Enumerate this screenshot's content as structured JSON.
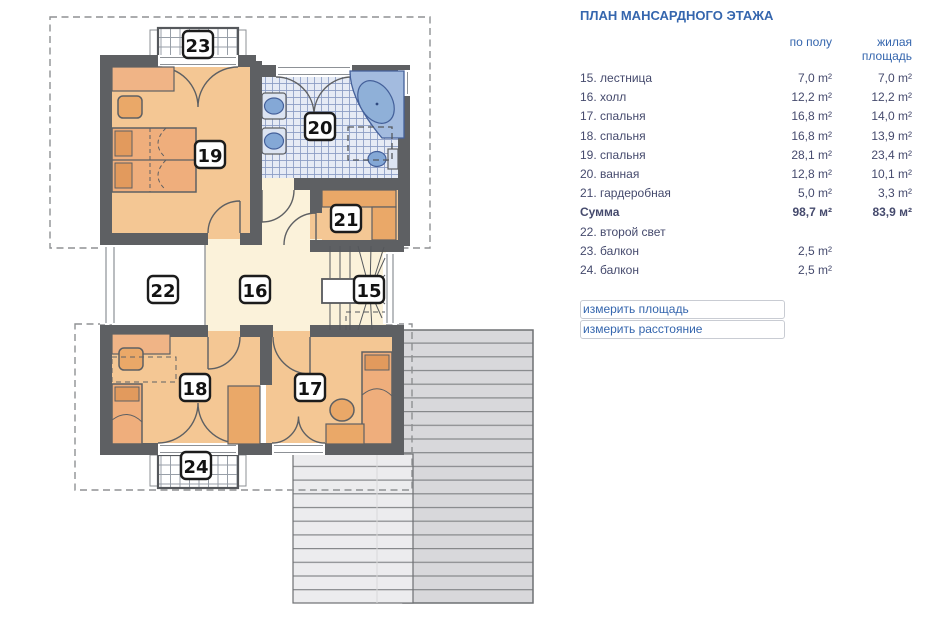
{
  "plan": {
    "labels": {
      "r15": "15",
      "r16": "16",
      "r17": "17",
      "r18": "18",
      "r19": "19",
      "r20": "20",
      "r21": "21",
      "r22": "22",
      "r23": "23",
      "r24": "24"
    }
  },
  "table": {
    "title": "ПЛАН МАНСАРДНОГО ЭТАЖА",
    "col_floor_header": "по полу",
    "col_living_header_line1": "жилая",
    "col_living_header_line2": "площадь",
    "rows": [
      {
        "name": "15. лестница",
        "floor": "7,0 m²",
        "living": "7,0 m²"
      },
      {
        "name": "16. холл",
        "floor": "12,2 m²",
        "living": "12,2 m²"
      },
      {
        "name": "17. спальня",
        "floor": "16,8 m²",
        "living": "14,0 m²"
      },
      {
        "name": "18. спальня",
        "floor": "16,8 m²",
        "living": "13,9 m²"
      },
      {
        "name": "19. спальня",
        "floor": "28,1 m²",
        "living": "23,4 m²"
      },
      {
        "name": "20. ванная",
        "floor": "12,8 m²",
        "living": "10,1 m²"
      },
      {
        "name": "21. гардеробная",
        "floor": "5,0 m²",
        "living": "3,3 m²"
      }
    ],
    "sum_row": {
      "name": "Сумма",
      "floor": "98,7 м²",
      "living": "83,9 м²"
    },
    "extra_rows": [
      {
        "name": "22. второй свет",
        "floor": "",
        "living": ""
      },
      {
        "name": "23. балкон",
        "floor": "2,5 m²",
        "living": ""
      },
      {
        "name": "24. балкон",
        "floor": "2,5 m²",
        "living": ""
      }
    ],
    "links": {
      "measure_area": "измерить площадь",
      "measure_distance": "измерить расстояние"
    }
  },
  "colors": {
    "accent_blue": "#3566ae",
    "text_navy": "#454a6d",
    "wall_gray": "#5e6063",
    "room_peach": "#f4c794",
    "hall_cream": "#fbf2da",
    "furniture_orange": "#eaa868",
    "bath_fixture_blue": "#8fb0d8",
    "roof_gray": "#d8d8db"
  }
}
